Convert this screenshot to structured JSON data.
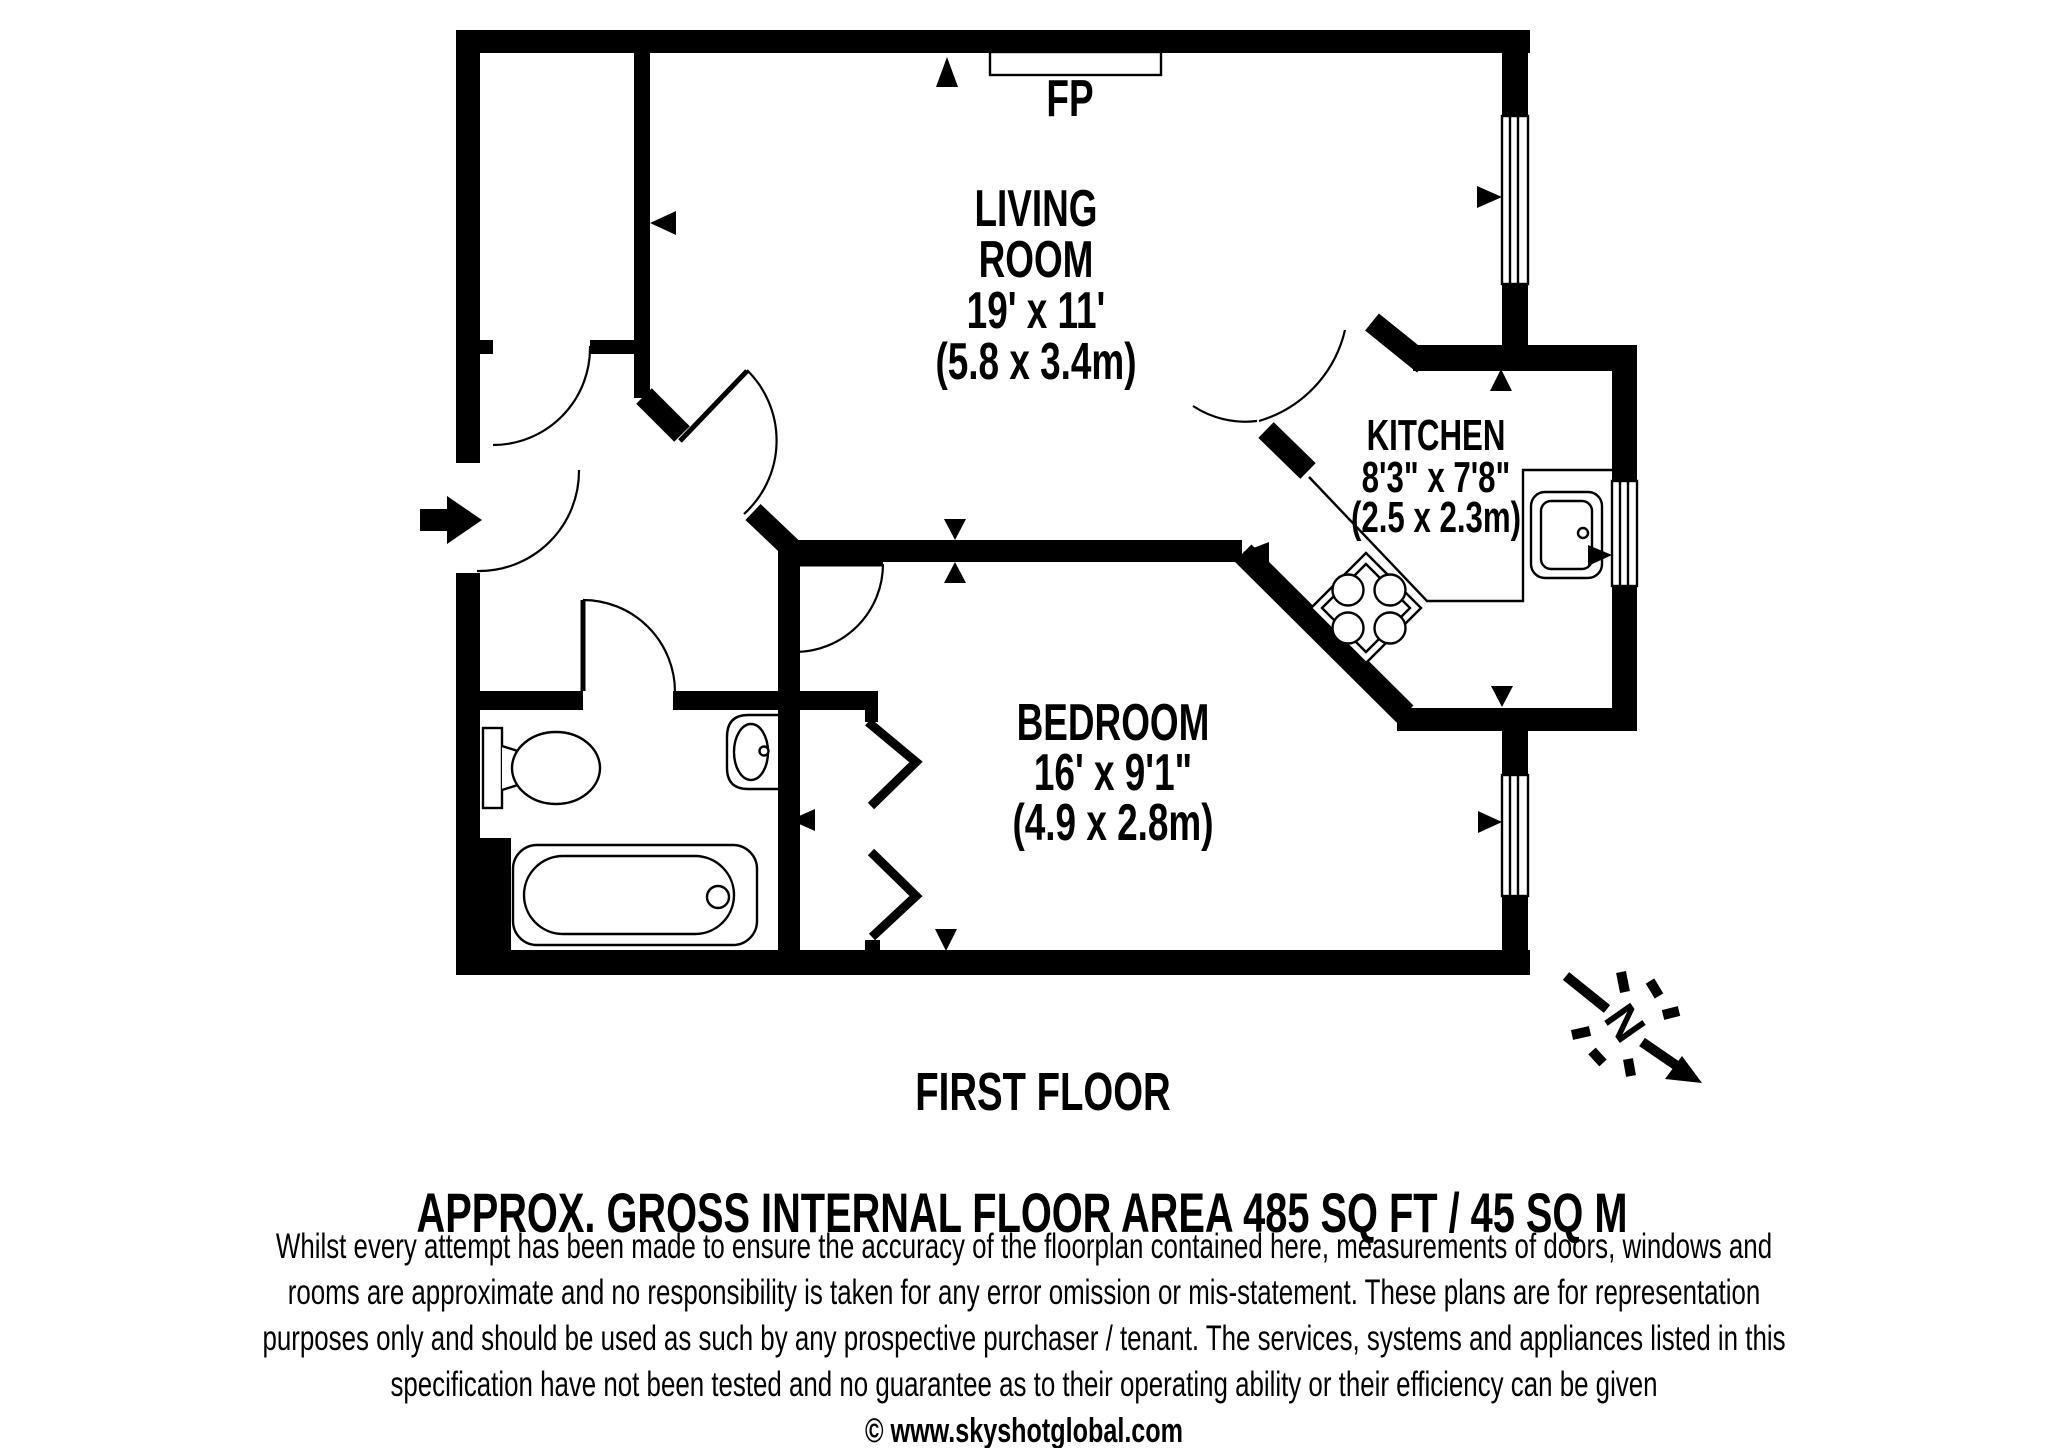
{
  "plan": {
    "fireplace_label": "FP",
    "floor_label": "FIRST FLOOR",
    "compass_label": "N",
    "rooms": [
      {
        "id": "living-room",
        "lines": [
          "LIVING",
          "ROOM",
          "19' x 11'",
          "(5.8 x 3.4m)"
        ]
      },
      {
        "id": "kitchen",
        "lines": [
          "KITCHEN",
          "8'3\" x 7'8\"",
          "(2.5 x 2.3m)"
        ]
      },
      {
        "id": "bedroom",
        "lines": [
          "BEDROOM",
          "16' x 9'1\"",
          "(4.9 x 2.8m)"
        ]
      }
    ]
  },
  "footer": {
    "area_line": "APPROX. GROSS INTERNAL FLOOR AREA 485 SQ FT / 45 SQ M",
    "disclaimer_lines": [
      "Whilst every attempt has been made to ensure the accuracy of the floorplan contained here, measurements of doors, windows and",
      "rooms are approximate and no responsibility is taken for any error omission or mis-statement. These plans are for representation",
      "purposes only and should be used as such by any prospective purchaser / tenant. The services, systems and appliances listed in this",
      "specification have not been tested and no guarantee as to their operating ability or their efficiency can be given"
    ],
    "copyright": "© www.skyshotglobal.com"
  },
  "colors": {
    "ink": "#000000",
    "paper": "#ffffff"
  }
}
